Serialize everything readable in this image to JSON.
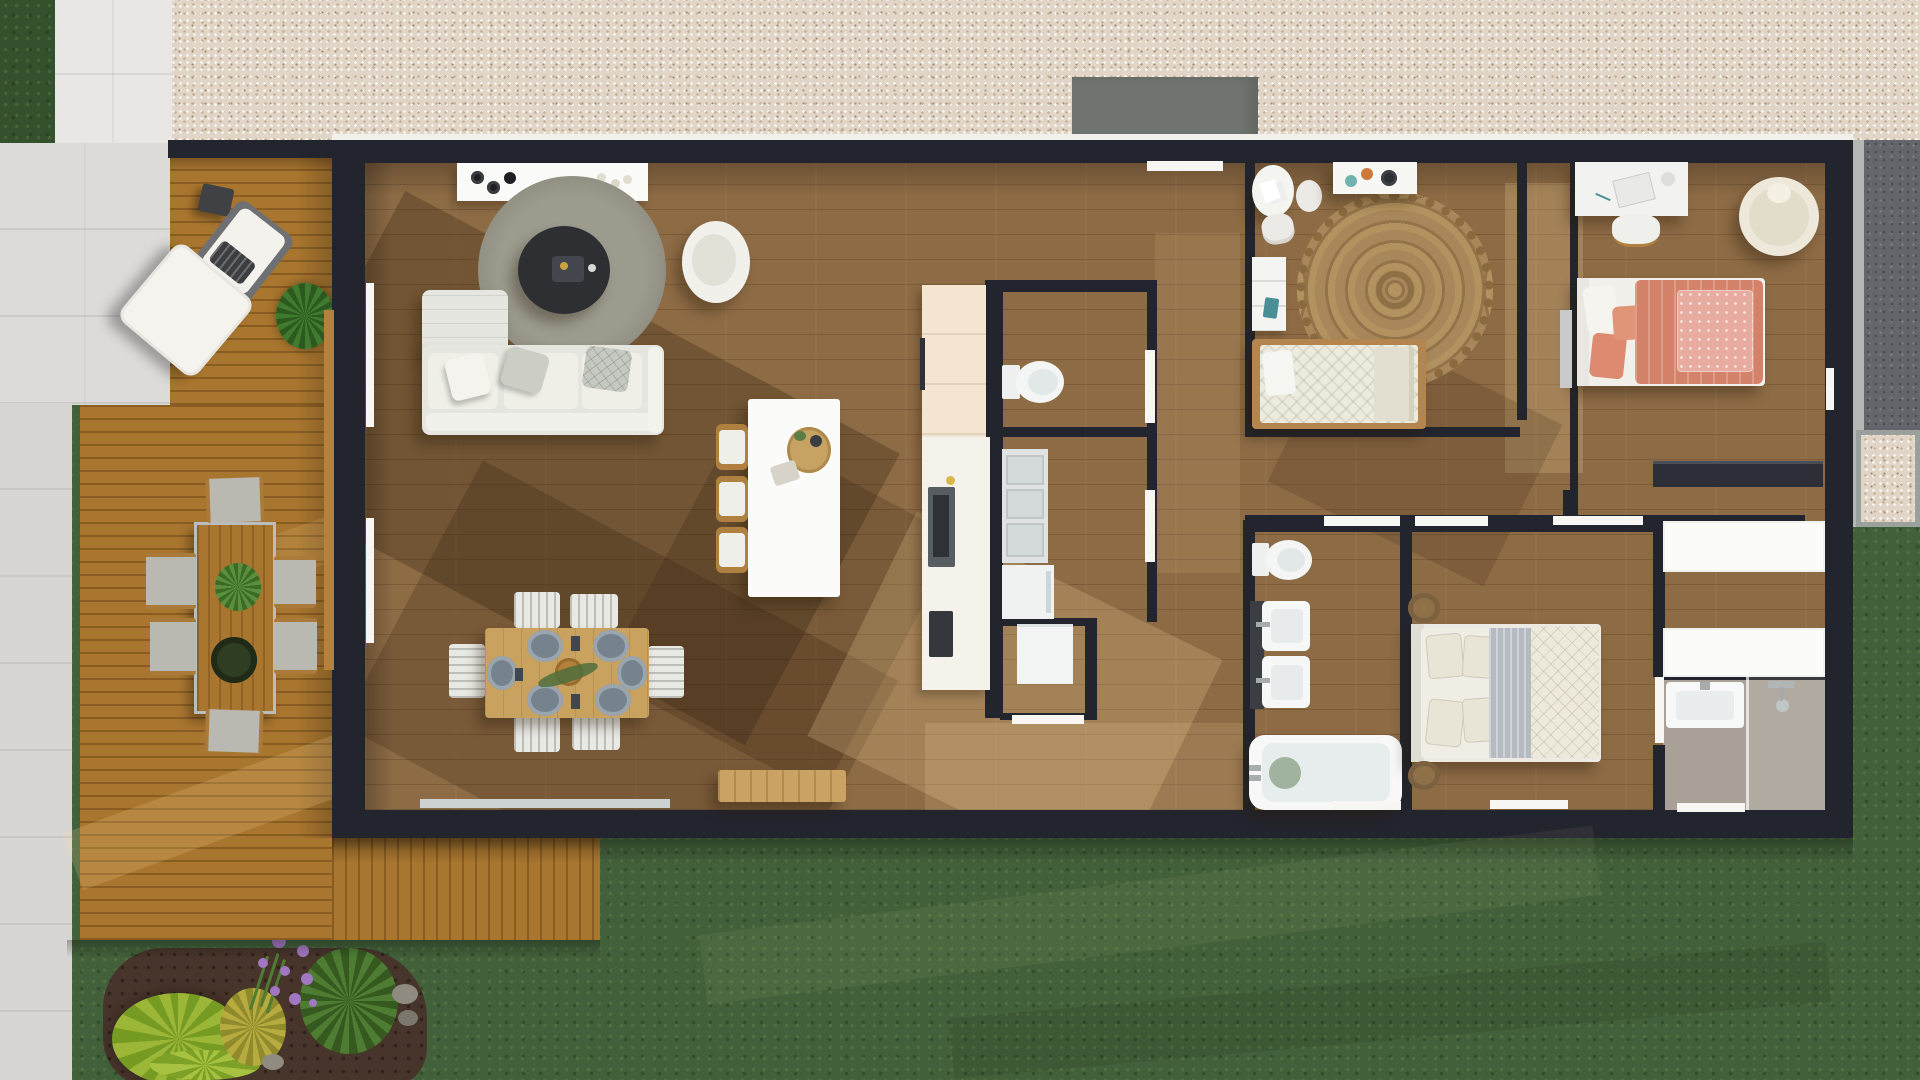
{
  "scene": {
    "description": "3D top-down architectural floor plan rendering of a single-storey house with wooden deck, gravel driveway, lawn and garden bed",
    "view": "top-down",
    "canvas": {
      "width": 1920,
      "height": 1080
    }
  },
  "palette": {
    "wall": "#23252e",
    "doorWhite": "#f7f6f2",
    "gravel": "#e0d5c7",
    "gravelDark": "#63666a",
    "concrete": "#70746e",
    "concreteLight": "#b4b8b4",
    "tile": "#e9e7e4",
    "deck": "#a9762f",
    "floor": "#8d6b45",
    "grass": "#42603a",
    "mulch": "#47342a",
    "white": "#f6f5f1",
    "cream": "#f3e5cf",
    "sofaGray": "#e6e6e0",
    "rugGray": "#98978a",
    "jute": "#a8885a",
    "coral": "#d5826a",
    "coralLight": "#e7aba0",
    "plate": "#76838f",
    "woodTable": "#c9a260",
    "teal": "#4a8f96",
    "purple": "#a177c2",
    "lime": "#9cb637",
    "leaf": "#4e7c33",
    "taupeFloor": "#a9a197",
    "chrome": "#a7adad"
  },
  "exterior": {
    "ground_areas": [
      {
        "name": "gravel-driveway",
        "color": "#e0d5c7"
      },
      {
        "name": "dark-gravel-side-strip",
        "color": "#63666a"
      },
      {
        "name": "concrete-entry-pad",
        "color": "#70746e"
      },
      {
        "name": "tiled-walkway",
        "color": "#e9e7e4"
      },
      {
        "name": "lawn",
        "color": "#42603a"
      },
      {
        "name": "garden-mulch-bed",
        "color": "#47342a"
      },
      {
        "name": "wooden-deck",
        "color": "#a9762f"
      }
    ],
    "deck_furniture": [
      "outdoor-lounge-chair",
      "outdoor-ottoman",
      "outdoor-side-table",
      "potted-plant",
      "outdoor-dining-table",
      "outdoor-dining-chairs-x6"
    ],
    "garden_plants": [
      "lime-foliage-plant",
      "yellow-fern",
      "purple-allium-flowers",
      "green-spike-grass",
      "rocks"
    ]
  },
  "house": {
    "rooms": [
      {
        "name": "living-room",
        "furniture": [
          "tv-console",
          "round-rug",
          "round-coffee-table",
          "swivel-armchair",
          "sectional-sofa",
          "throw-pillows"
        ]
      },
      {
        "name": "dining-area",
        "furniture": [
          "dining-table",
          "dining-chairs-x6",
          "plates-x6",
          "bread-basket"
        ]
      },
      {
        "name": "kitchen",
        "furniture": [
          "kitchen-island",
          "bar-stools-x3",
          "tall-cabinet-fridge",
          "counter-with-cooktop",
          "oven"
        ]
      },
      {
        "name": "wc",
        "furniture": [
          "toilet"
        ]
      },
      {
        "name": "laundry",
        "furniture": [
          "dishwasher-open",
          "washing-machine",
          "dryer"
        ]
      },
      {
        "name": "entry-corridor",
        "furniture": [
          "front-door",
          "console-bench"
        ]
      },
      {
        "name": "study-bedroom",
        "furniture": [
          "round-table",
          "side-stool",
          "chair",
          "play-shelf",
          "jute-mandala-rug",
          "dresser",
          "daybed"
        ]
      },
      {
        "name": "coral-bedroom",
        "furniture": [
          "desk",
          "desk-chair",
          "papasan-chair",
          "double-bed-coral",
          "dark-wardrobe"
        ]
      },
      {
        "name": "main-bathroom",
        "furniture": [
          "toilet",
          "double-sink-vanity",
          "bathtub"
        ]
      },
      {
        "name": "rear-bedroom",
        "furniture": [
          "double-bed-white",
          "jute-pouf-x2"
        ]
      },
      {
        "name": "walk-in-closet",
        "furniture": [
          "white-wardrobe-x2"
        ]
      },
      {
        "name": "shower-bathroom",
        "furniture": [
          "sink",
          "shower-set",
          "glass-screen"
        ]
      }
    ]
  }
}
